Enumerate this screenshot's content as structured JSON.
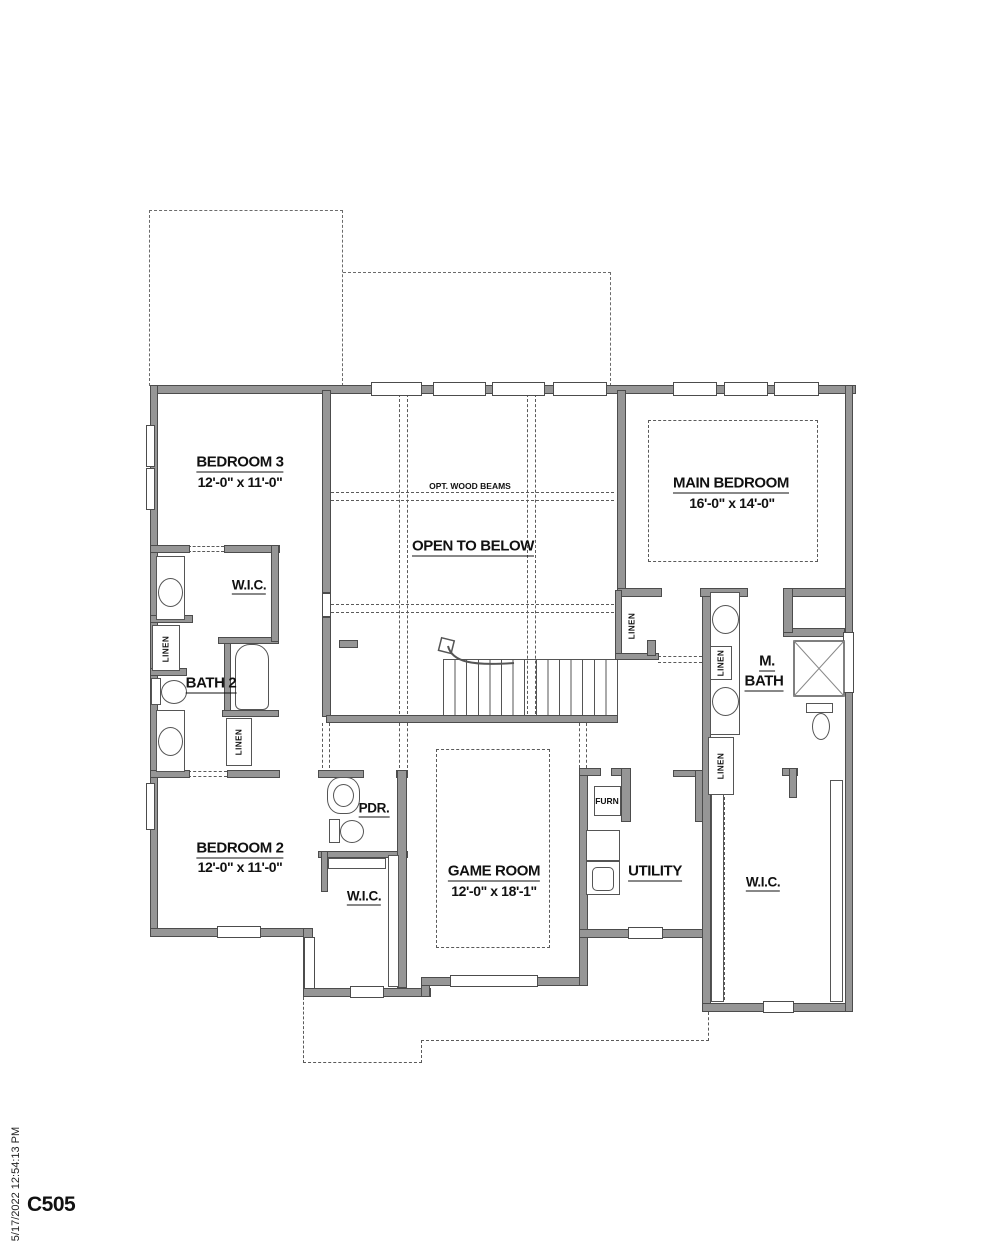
{
  "sheet": {
    "number": "C505",
    "plot_stamp": "5/17/2022 12:54:13 PM"
  },
  "rooms": {
    "bedroom3": {
      "name": "BEDROOM 3",
      "dims": "12'-0\" x 11'-0\""
    },
    "bedroom2": {
      "name": "BEDROOM 2",
      "dims": "12'-0\" x 11'-0\""
    },
    "main_bedroom": {
      "name": "MAIN BEDROOM",
      "dims": "16'-0\" x 14'-0\""
    },
    "game_room": {
      "name": "GAME ROOM",
      "dims": "12'-0\" x 18'-1\""
    },
    "open_to_below": {
      "name": "OPEN TO BELOW"
    },
    "bath2": {
      "name": "BATH 2"
    },
    "m_bath": {
      "line1": "M.",
      "line2": "BATH"
    },
    "pdr": {
      "name": "PDR."
    },
    "utility": {
      "name": "UTILITY"
    },
    "wic": {
      "name": "W.I.C."
    },
    "linen": {
      "name": "LINEN"
    },
    "furn": {
      "name": "FURN"
    }
  },
  "annotations": {
    "opt_wood_beams": "OPT. WOOD BEAMS"
  }
}
